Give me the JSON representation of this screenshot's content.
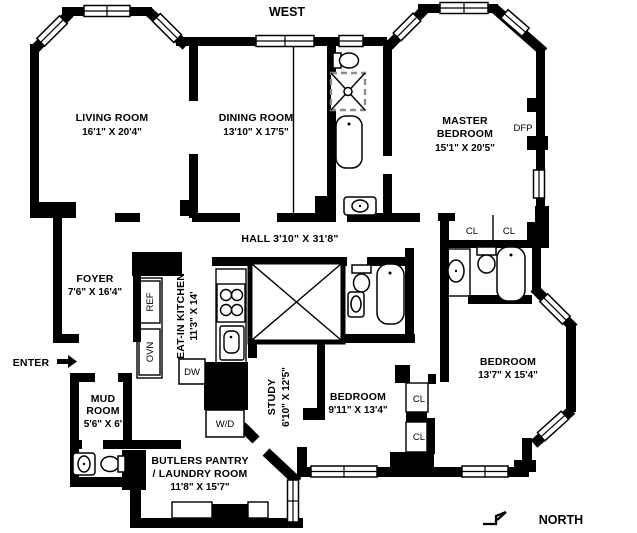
{
  "plan": {
    "compass": {
      "west": "WEST",
      "north": "NORTH",
      "enter": "ENTER"
    },
    "rooms": {
      "living_room": {
        "name": "LIVING ROOM",
        "dims": "16'1\" X 20'4\""
      },
      "dining_room": {
        "name": "DINING ROOM",
        "dims": "13'10\" X 17'5\""
      },
      "master_bedroom": {
        "name_line1": "MASTER",
        "name_line2": "BEDROOM",
        "dims": "15'1\" X 20'5\""
      },
      "hall": {
        "label": "HALL 3'10\" X 31'8\""
      },
      "foyer": {
        "name": "FOYER",
        "dims": "7'6\" X 16'4\""
      },
      "eat_in_kitchen": {
        "name": "EAT-IN KITCHEN",
        "dims": "11'3\" X 14'"
      },
      "mud_room": {
        "name_line1": "MUD",
        "name_line2": "ROOM",
        "dims": "5'6\" X 6'"
      },
      "butlers_pantry": {
        "name_line1": "BUTLERS PANTRY",
        "name_line2": "/ LAUNDRY ROOM",
        "dims": "11'8\" X 15'7\""
      },
      "study": {
        "name": "STUDY",
        "dims": "6'10\" X 12'5\""
      },
      "bedroom_mid": {
        "name": "BEDROOM",
        "dims": "9'11\" X 13'4\""
      },
      "bedroom_right": {
        "name": "BEDROOM",
        "dims": "13'7\" X 15'4\""
      }
    },
    "labels": {
      "dfp": "DFP",
      "closet": "CL",
      "ref": "REF",
      "oven": "OVN",
      "dishwasher": "DW",
      "washer_dryer": "W/D"
    },
    "colors": {
      "wall": "#000000",
      "background": "#ffffff"
    }
  }
}
